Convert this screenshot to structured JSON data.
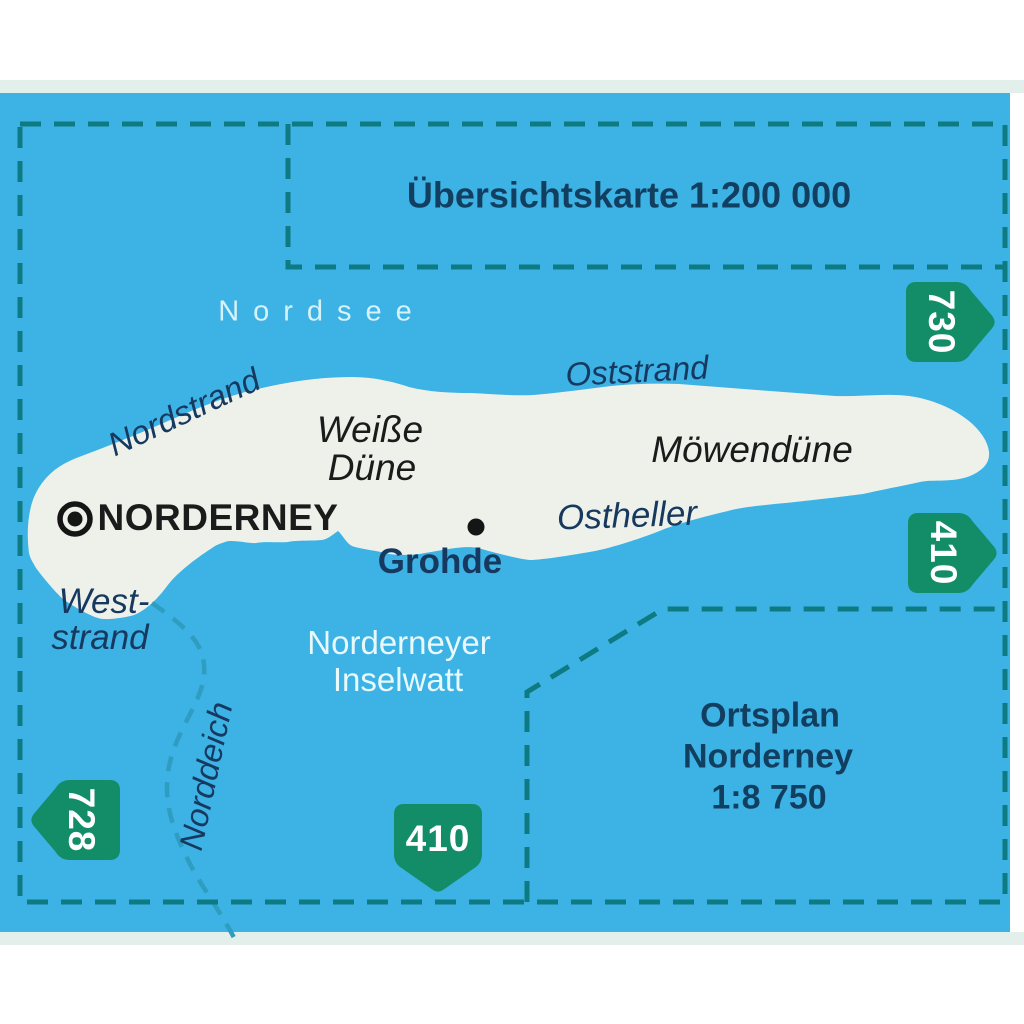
{
  "title": "Übersichtskarte 1:200 000",
  "sea": "Nordsee",
  "features": {
    "nordstrand": "Nordstrand",
    "oststrand": "Oststrand",
    "weisse_duene": [
      "Weiße",
      "Düne"
    ],
    "moewenduene": "Möwendüne",
    "ostheller": "Ostheller",
    "town": "NORDERNEY",
    "grohde": "Grohde",
    "weststrand": [
      "West-",
      "strand"
    ],
    "inselwatt": [
      "Norderneyer",
      "Inselwatt"
    ],
    "norddeich": "Norddeich"
  },
  "ortsplan": [
    "Ortsplan",
    "Norderney",
    "1:8 750"
  ],
  "badges": {
    "right_top": "730",
    "right_mid": "410",
    "left": "728",
    "bottom": "410"
  },
  "colors": {
    "sea": "#3cb2e5",
    "island": "#edf1ea",
    "top_bottom_band": "#e2efeb",
    "frame_dash": "#0e7a81",
    "ferry_dash": "#2f9dc0",
    "badge_green": "#128d68",
    "label_navy": "#17395f",
    "label_black": "#1b1b1b",
    "sea_label": "#d7f2f7",
    "watt_label": "#e8f9fc"
  }
}
